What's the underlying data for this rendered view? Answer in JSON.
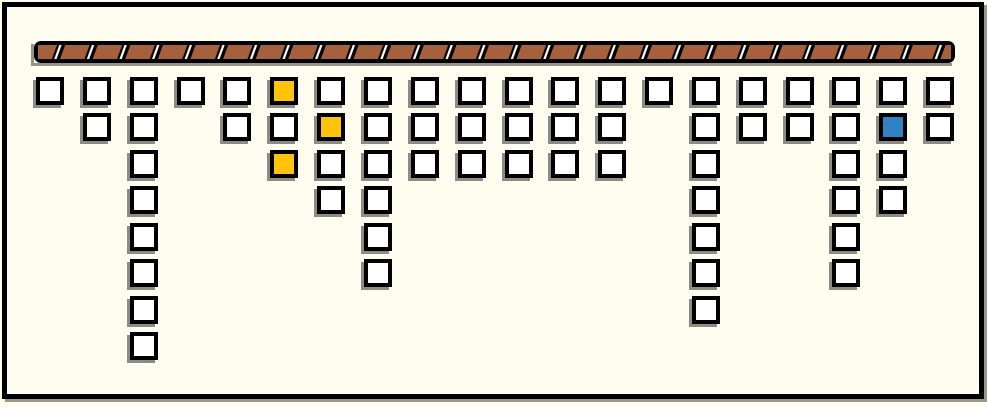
{
  "scene": {
    "background": "#FFFDF0",
    "frame_color": "#000000",
    "shadow_color": "rgba(0,0,0,0.42)"
  },
  "beam": {
    "description": "hatched-girder-ceiling",
    "fill_brown": "#A6613C",
    "stripe_black": "#000000",
    "stripe_white": "#FFFFFF",
    "outline": "#000000",
    "segment_count": 28
  },
  "board": {
    "columns": 20,
    "rows": 8,
    "tile_border_color": "#000000",
    "tile_colors": {
      "white": "#FFFFFF",
      "yellow": "#FFC30B",
      "blue": "#3182C3"
    },
    "colored_tiles": [
      {
        "col": 6,
        "row": 1,
        "color": "yellow"
      },
      {
        "col": 7,
        "row": 2,
        "color": "yellow"
      },
      {
        "col": 6,
        "row": 3,
        "color": "yellow"
      },
      {
        "col": 19,
        "row": 2,
        "color": "blue"
      }
    ],
    "stacks": [
      {
        "col": 1,
        "cells": [
          "white"
        ]
      },
      {
        "col": 2,
        "cells": [
          "white",
          "white"
        ]
      },
      {
        "col": 3,
        "cells": [
          "white",
          "white",
          "white",
          "white",
          "white",
          "white",
          "white",
          "white"
        ]
      },
      {
        "col": 4,
        "cells": [
          "white"
        ]
      },
      {
        "col": 5,
        "cells": [
          "white",
          "white"
        ]
      },
      {
        "col": 6,
        "cells": [
          "yellow",
          "white",
          "yellow"
        ]
      },
      {
        "col": 7,
        "cells": [
          "white",
          "yellow",
          "white",
          "white"
        ]
      },
      {
        "col": 8,
        "cells": [
          "white",
          "white",
          "white",
          "white",
          "white",
          "white"
        ]
      },
      {
        "col": 9,
        "cells": [
          "white",
          "white",
          "white"
        ]
      },
      {
        "col": 10,
        "cells": [
          "white",
          "white",
          "white"
        ]
      },
      {
        "col": 11,
        "cells": [
          "white",
          "white",
          "white"
        ]
      },
      {
        "col": 12,
        "cells": [
          "white",
          "white",
          "white"
        ]
      },
      {
        "col": 13,
        "cells": [
          "white",
          "white",
          "white"
        ]
      },
      {
        "col": 14,
        "cells": [
          "white"
        ]
      },
      {
        "col": 15,
        "cells": [
          "white",
          "white",
          "white",
          "white",
          "white",
          "white",
          "white"
        ]
      },
      {
        "col": 16,
        "cells": [
          "white",
          "white"
        ]
      },
      {
        "col": 17,
        "cells": [
          "white",
          "white"
        ]
      },
      {
        "col": 18,
        "cells": [
          "white",
          "white",
          "white",
          "white",
          "white",
          "white"
        ]
      },
      {
        "col": 19,
        "cells": [
          "white",
          "blue",
          "white",
          "white"
        ]
      },
      {
        "col": 20,
        "cells": [
          "white",
          "white"
        ]
      }
    ]
  },
  "geometry": {
    "col_origin_x": 36,
    "col_spacing": 46.85,
    "row_origin_y": 76.5,
    "row_spacing": 36.5,
    "tile_outer_size": 28,
    "beam": {
      "x": 34,
      "y": 41,
      "width": 921,
      "height": 22,
      "border": 4
    }
  }
}
